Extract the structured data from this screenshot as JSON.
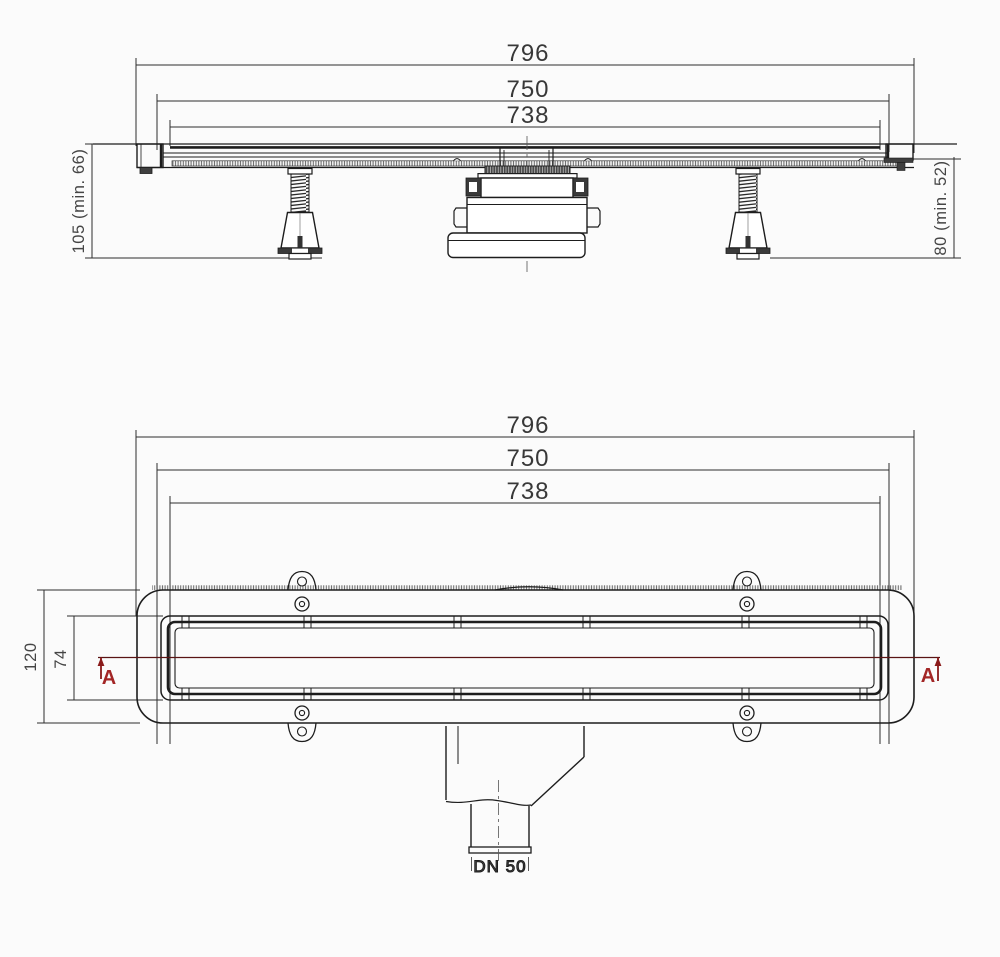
{
  "drawing": {
    "background": "#fbfbfb",
    "line_color": "#1d1d1d",
    "dim_color": "#383838",
    "section_color": "#a32626",
    "side_view": {
      "dims": {
        "overall": "796",
        "outer": "750",
        "inner": "738",
        "height_left": "105 (min. 66)",
        "height_right": "80 (min. 52)"
      }
    },
    "plan_view": {
      "dims": {
        "overall": "796",
        "outer": "750",
        "inner": "738",
        "total_width": "120",
        "channel_width": "74"
      },
      "section_marker_left": "A",
      "section_marker_right": "A",
      "outlet_size": "DN 50"
    }
  }
}
